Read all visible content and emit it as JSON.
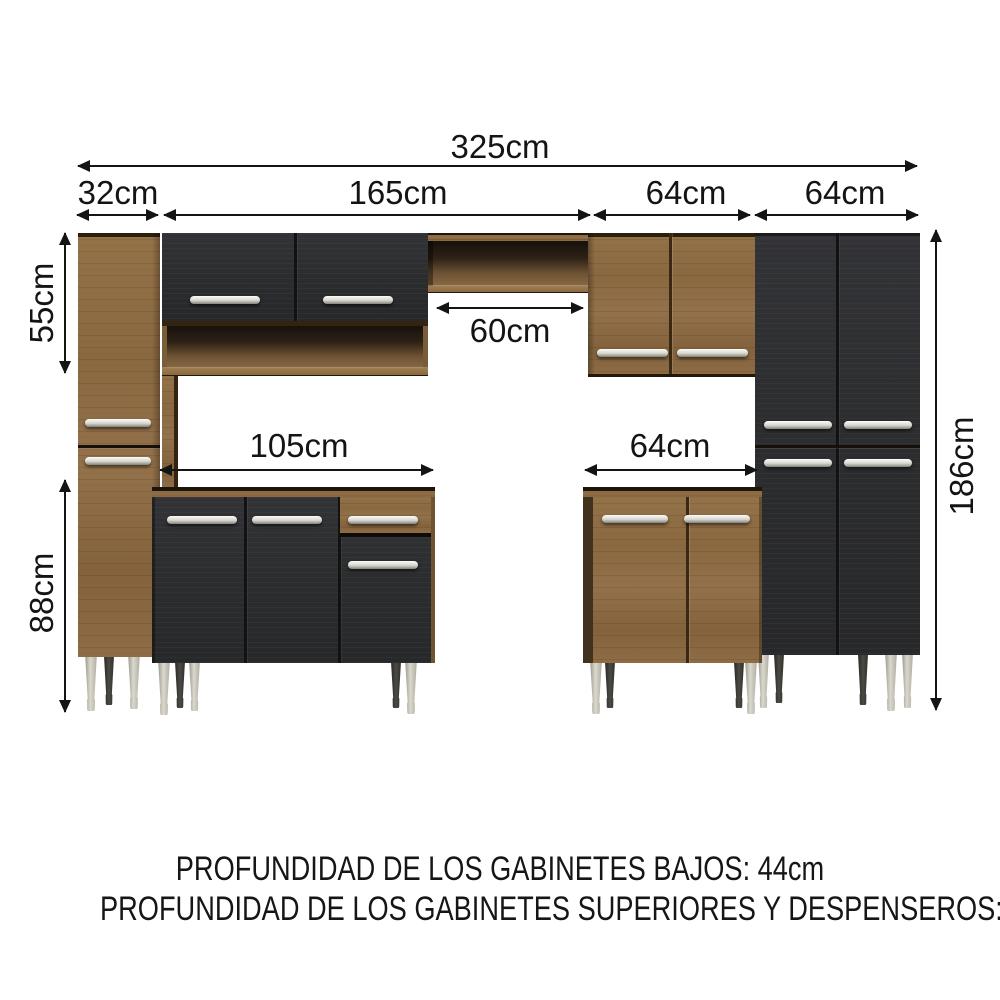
{
  "diagram": {
    "dims": {
      "total_width": "325cm",
      "segments": [
        "32cm",
        "165cm",
        "64cm",
        "64cm"
      ],
      "upper_left_height": "55cm",
      "base_height": "88cm",
      "pantry_height": "186cm",
      "center_opening": "60cm",
      "base_left_width": "105cm",
      "base_right_width": "64cm"
    },
    "footer": {
      "line1": "PROFUNDIDAD DE LOS GABINETES BAJOS: 44cm",
      "line2": "PROFUNDIDAD DE LOS GABINETES SUPERIORES Y DESPENSEROS: 27cm"
    },
    "colors": {
      "wood": "#8d6b44",
      "wood_dark": "#3a2912",
      "door_black": "#2c2d2e",
      "handle_silver": "#d9d8d1",
      "leg_silver": "#c4c2b6",
      "dimension_ink": "#141414",
      "background": "#ffffff"
    }
  }
}
